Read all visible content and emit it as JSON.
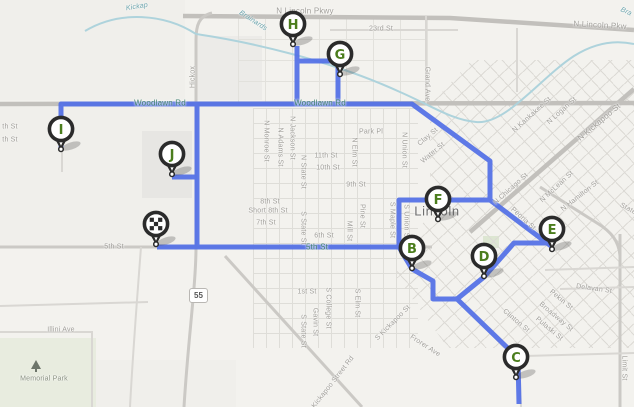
{
  "map": {
    "city_label": "Lincoln",
    "park_label": "Memorial Park",
    "highway_shield": "55",
    "colors": {
      "route": "#516fe6",
      "water": "#aed3dc",
      "marker_ring": "#2b2b2b",
      "marker_letter": "#4b7d1d",
      "label_gray": "#a09e99",
      "label_teal": "#3f7f70"
    },
    "markers": [
      {
        "id": "start",
        "type": "checkered",
        "x": 156,
        "y": 246
      },
      {
        "id": "B",
        "letter": "B",
        "type": "letter",
        "x": 412,
        "y": 270
      },
      {
        "id": "C",
        "letter": "C",
        "type": "letter",
        "x": 516,
        "y": 379
      },
      {
        "id": "D",
        "letter": "D",
        "type": "letter",
        "x": 484,
        "y": 278
      },
      {
        "id": "E",
        "letter": "E",
        "type": "letter",
        "x": 552,
        "y": 251
      },
      {
        "id": "F",
        "letter": "F",
        "type": "letter",
        "x": 438,
        "y": 221
      },
      {
        "id": "G",
        "letter": "G",
        "type": "letter",
        "x": 340,
        "y": 76
      },
      {
        "id": "H",
        "letter": "H",
        "type": "letter",
        "x": 293,
        "y": 46
      },
      {
        "id": "I",
        "letter": "I",
        "type": "letter",
        "x": 61,
        "y": 151
      },
      {
        "id": "J",
        "letter": "J",
        "type": "letter",
        "x": 172,
        "y": 176
      }
    ],
    "route_path": "M 61,151 L 61,104 L 412,104 L 490,161 L 490,200 L 551,246 M 490,200 L 399,200 L 399,247 L 157,247 M 297,104 L 297,46 M 297,61 L 338,61 L 338,104 M 197,104 L 197,247 M 172,177 L 197,177 M 399,247 L 412,269 L 433,281 L 433,299 L 457,299 L 484,277 M 457,299 L 518,358 L 519,404 M 484,277 L 514,243 L 551,243",
    "roads": [
      {
        "d": "M 183,16 L 450,18 L 634,30",
        "c": "major"
      },
      {
        "d": "M 0,104 L 634,103",
        "c": "major"
      },
      {
        "d": "M 470,232 L 634,89",
        "c": "major"
      },
      {
        "d": "M 212,13 C 199,16 196,25 196,40 L 196,247 C 196,285 188,340 184,407",
        "c": "med"
      },
      {
        "d": "M 0,247 L 432,247",
        "c": "med"
      },
      {
        "d": "M 620,234 L 620,407",
        "c": "med"
      },
      {
        "d": "M 540,187 L 597,223 C 612,232 619,242 620,256",
        "c": "med"
      },
      {
        "d": "M 225,256 L 362,407",
        "c": "med"
      },
      {
        "d": "M 426,16 L 426,104",
        "c": "min"
      },
      {
        "d": "M 330,30 L 458,30",
        "c": "min"
      },
      {
        "d": "M 62,104 L 62,172",
        "c": "min"
      },
      {
        "d": "M 0,306 L 148,302",
        "c": "min"
      },
      {
        "d": "M 0,332 L 92,332 L 92,407",
        "c": "min"
      },
      {
        "d": "M 141,247 C 137,300 133,350 130,407",
        "c": "min"
      },
      {
        "d": "M 517,28 L 517,92",
        "c": "min"
      },
      {
        "d": "M 560,289 L 634,287",
        "c": "min"
      },
      {
        "d": "M 545,270 L 634,267",
        "c": "min"
      },
      {
        "d": "M 525,356 L 634,353",
        "c": "min"
      },
      {
        "d": "M 519,358 L 521,407",
        "c": "min"
      }
    ],
    "creeks": [
      {
        "d": "M 85,31 C 120,10 165,14 196,34"
      },
      {
        "d": "M 196,34 C 250,42 330,60 400,92 C 432,106 452,120 476,122 C 506,125 540,78 574,56 C 596,42 616,40 634,44"
      }
    ],
    "blocks": [
      {
        "x": 0,
        "y": 0,
        "w": 185,
        "h": 100,
        "f": "#f0efeb"
      },
      {
        "x": 0,
        "y": 106,
        "w": 253,
        "h": 141,
        "f": "#f0efeb"
      },
      {
        "x": 142,
        "y": 131,
        "w": 50,
        "h": 67,
        "f": "#e7e6e3"
      },
      {
        "x": 196,
        "y": 36,
        "w": 66,
        "h": 64,
        "f": "#ecebe8"
      },
      {
        "x": 483,
        "y": 236,
        "w": 16,
        "h": 12,
        "f": "#dde6d2"
      },
      {
        "x": 0,
        "y": 338,
        "w": 96,
        "h": 69,
        "f": "#e8ecdf"
      },
      {
        "x": 96,
        "y": 360,
        "w": 140,
        "h": 47,
        "f": "#f0efeb"
      }
    ],
    "labels": [
      {
        "t": "N Lincoln Pkwy",
        "x": 305,
        "y": 11,
        "r": 0,
        "c": "big"
      },
      {
        "t": "N Lincoln Pkw",
        "x": 600,
        "y": 25,
        "r": 3,
        "c": "big"
      },
      {
        "t": "23rd St",
        "x": 381,
        "y": 29,
        "r": 0
      },
      {
        "t": "Grand Ave",
        "x": 427,
        "y": 84,
        "r": 90
      },
      {
        "t": "Brainards",
        "x": 253,
        "y": 21,
        "r": 33,
        "c": "water"
      },
      {
        "t": "Kickap",
        "x": 137,
        "y": 7,
        "r": -9,
        "c": "water"
      },
      {
        "t": "Bra",
        "x": 626,
        "y": 12,
        "r": 25,
        "c": "water"
      },
      {
        "t": "Hickox",
        "x": 193,
        "y": 77,
        "r": -90
      },
      {
        "t": "Woodlawn Rd",
        "x": 160,
        "y": 103,
        "r": 0,
        "c": "teal"
      },
      {
        "t": "Woodlawn Rd",
        "x": 320,
        "y": 103,
        "r": 0,
        "c": "teal"
      },
      {
        "t": "Park Pl",
        "x": 371,
        "y": 132,
        "r": 0
      },
      {
        "t": "N Union St",
        "x": 404,
        "y": 150,
        "r": 90
      },
      {
        "t": "Clay St",
        "x": 428,
        "y": 137,
        "r": -40
      },
      {
        "t": "Water St",
        "x": 433,
        "y": 153,
        "r": -40
      },
      {
        "t": "N Monroe St",
        "x": 266,
        "y": 141,
        "r": 90
      },
      {
        "t": "N Adams St",
        "x": 280,
        "y": 147,
        "r": 90
      },
      {
        "t": "N Jackson St",
        "x": 292,
        "y": 138,
        "r": 90
      },
      {
        "t": "N State St",
        "x": 303,
        "y": 172,
        "r": 90
      },
      {
        "t": "N Elm St",
        "x": 354,
        "y": 152,
        "r": 90
      },
      {
        "t": "11th St",
        "x": 326,
        "y": 156,
        "r": 0
      },
      {
        "t": "10th St",
        "x": 328,
        "y": 168,
        "r": 0
      },
      {
        "t": "9th St",
        "x": 356,
        "y": 185,
        "r": 0
      },
      {
        "t": "8th St",
        "x": 270,
        "y": 202,
        "r": 0
      },
      {
        "t": "Short 8th St",
        "x": 268,
        "y": 211,
        "r": 0
      },
      {
        "t": "7th St",
        "x": 266,
        "y": 223,
        "r": 0
      },
      {
        "t": "6th St",
        "x": 324,
        "y": 236,
        "r": 0
      },
      {
        "t": "5th St",
        "x": 317,
        "y": 247,
        "r": 0,
        "c": "teal"
      },
      {
        "t": "5th St",
        "x": 114,
        "y": 247,
        "r": 0
      },
      {
        "t": "th St",
        "x": 10,
        "y": 127,
        "r": 0
      },
      {
        "t": "th St",
        "x": 10,
        "y": 140,
        "r": 0
      },
      {
        "t": "S State St",
        "x": 303,
        "y": 228,
        "r": 90
      },
      {
        "t": "Pine St",
        "x": 362,
        "y": 216,
        "r": 90
      },
      {
        "t": "Mill St",
        "x": 349,
        "y": 231,
        "r": 90
      },
      {
        "t": "S Maple St",
        "x": 392,
        "y": 220,
        "r": 90
      },
      {
        "t": "S Union St",
        "x": 406,
        "y": 222,
        "r": 90
      },
      {
        "t": "1st St",
        "x": 307,
        "y": 292,
        "r": 0
      },
      {
        "t": "S College St",
        "x": 328,
        "y": 308,
        "r": 90
      },
      {
        "t": "Gavin St",
        "x": 315,
        "y": 322,
        "r": 90
      },
      {
        "t": "S Elm St",
        "x": 357,
        "y": 303,
        "r": 90
      },
      {
        "t": "S State St",
        "x": 303,
        "y": 331,
        "r": 90
      },
      {
        "t": "S Kickapoo St",
        "x": 393,
        "y": 323,
        "r": -45
      },
      {
        "t": "Frorer Ave",
        "x": 425,
        "y": 346,
        "r": 33
      },
      {
        "t": "S Kickapoo Street Rd",
        "x": 331,
        "y": 385,
        "r": -52
      },
      {
        "t": "N Kankakee St",
        "x": 532,
        "y": 115,
        "r": -42
      },
      {
        "t": "N Logan St",
        "x": 562,
        "y": 111,
        "r": -42
      },
      {
        "t": "N Kickapoo St",
        "x": 599,
        "y": 122,
        "r": -40,
        "c": "big"
      },
      {
        "t": "N Chicago St",
        "x": 511,
        "y": 189,
        "r": -42
      },
      {
        "t": "N McLean St",
        "x": 557,
        "y": 187,
        "r": -43
      },
      {
        "t": "N Hamilton St",
        "x": 580,
        "y": 196,
        "r": -38
      },
      {
        "t": "Peoria St",
        "x": 523,
        "y": 219,
        "r": 42
      },
      {
        "t": "Pekin St",
        "x": 561,
        "y": 300,
        "r": 40
      },
      {
        "t": "Broadway St",
        "x": 556,
        "y": 317,
        "r": 40
      },
      {
        "t": "Pulaski St",
        "x": 549,
        "y": 329,
        "r": 40
      },
      {
        "t": "Clinton St",
        "x": 516,
        "y": 321,
        "r": 40
      },
      {
        "t": "Delavan St",
        "x": 594,
        "y": 289,
        "r": 8
      },
      {
        "t": "Limit St",
        "x": 624,
        "y": 368,
        "r": 90
      },
      {
        "t": "State",
        "x": 628,
        "y": 209,
        "r": 28
      },
      {
        "t": "Illini Ave",
        "x": 61,
        "y": 330,
        "r": 0
      },
      {
        "t": "Lincoln",
        "x": 437,
        "y": 211,
        "r": 0,
        "c": "city"
      },
      {
        "t": "Memorial Park",
        "x": 44,
        "y": 379,
        "r": 0,
        "c": "park"
      }
    ]
  }
}
